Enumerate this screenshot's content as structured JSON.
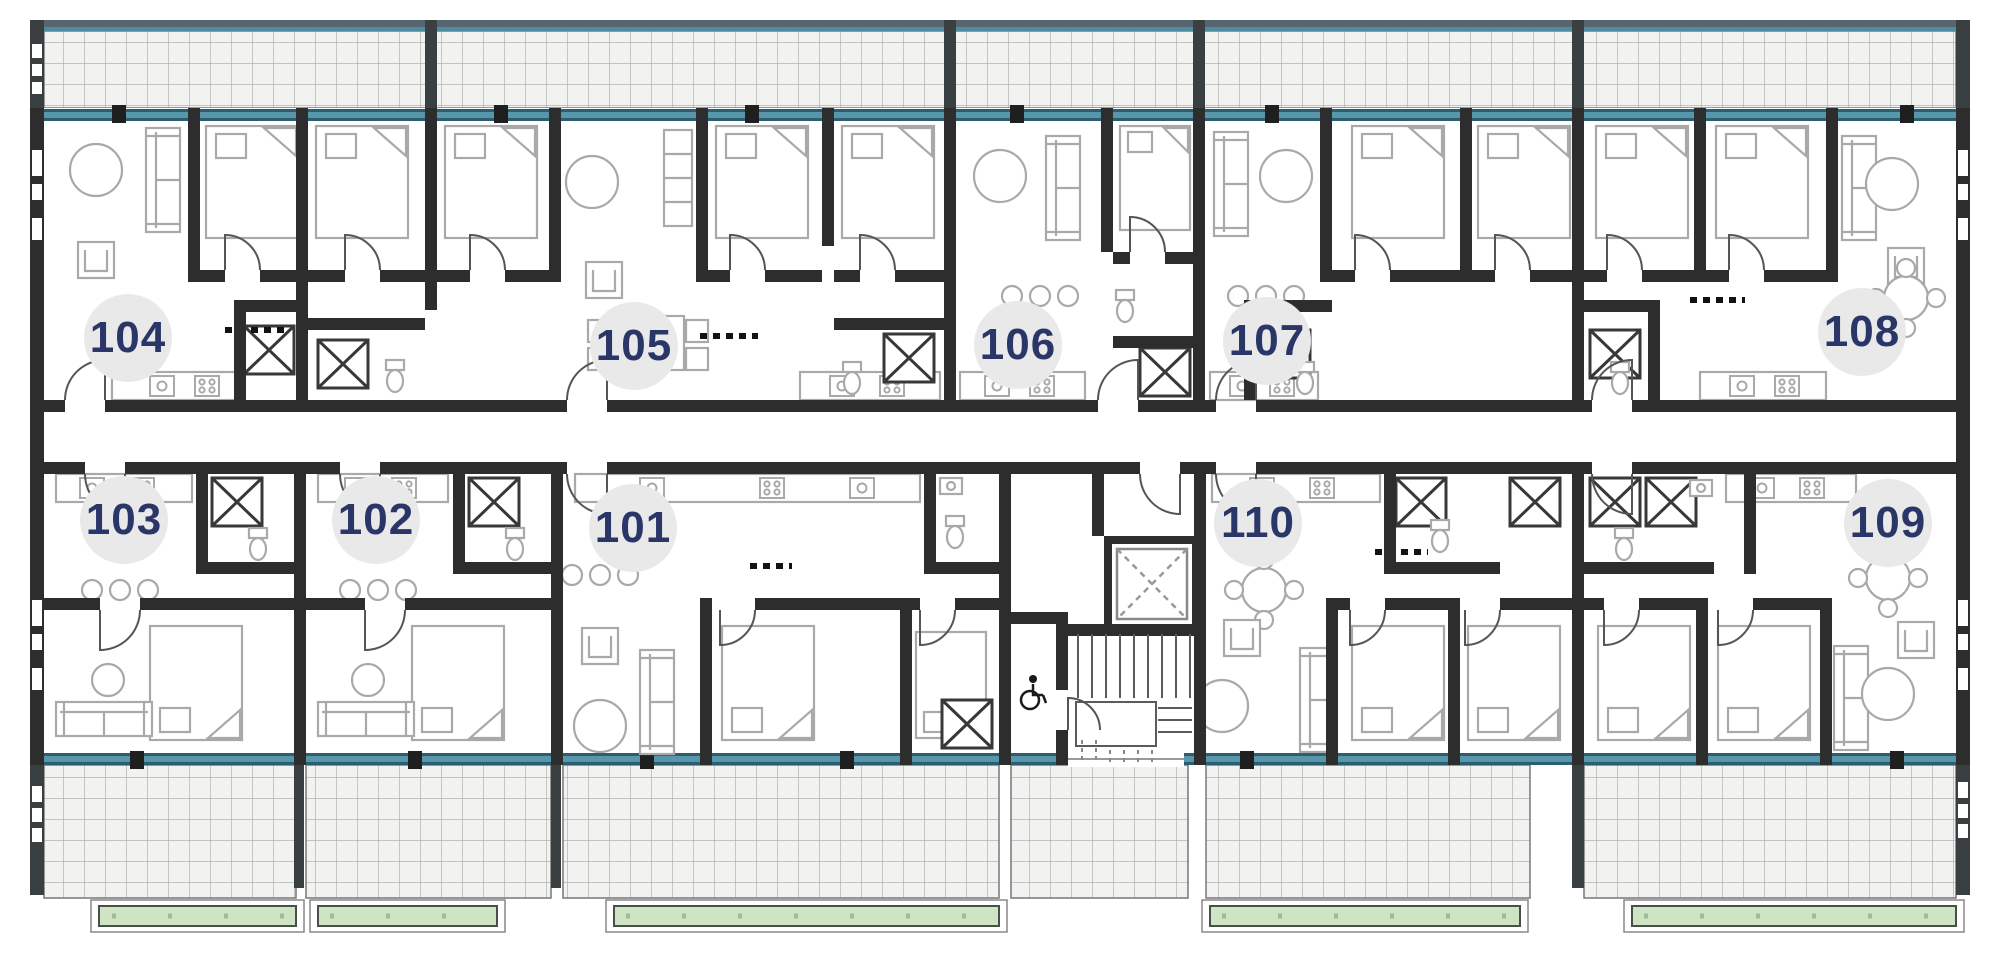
{
  "units": [
    {
      "number": "104",
      "row": "top"
    },
    {
      "number": "105",
      "row": "top"
    },
    {
      "number": "106",
      "row": "top"
    },
    {
      "number": "107",
      "row": "top"
    },
    {
      "number": "108",
      "row": "top"
    },
    {
      "number": "103",
      "row": "bottom"
    },
    {
      "number": "102",
      "row": "bottom"
    },
    {
      "number": "101",
      "row": "bottom"
    },
    {
      "number": "110",
      "row": "bottom"
    },
    {
      "number": "109",
      "row": "bottom"
    }
  ],
  "core": {
    "wheelchair_icon": "wheelchair-accessible-wc",
    "elevator_icon": "elevator-shaft-cross",
    "stairs_icon": "staircase-treads"
  },
  "colors": {
    "wall": "#2d2d2d",
    "terrace_partition": "#3a3f42",
    "window_frame": "#2d5e6f",
    "window_glass": "#5797ab",
    "railing": "#55666e",
    "railing_accent": "#4f8ca3",
    "terrace_fill": "#f2f2f0",
    "terrace_grid_line": "#a4a8a6",
    "green_area": "#cfe4c2",
    "green_border": "#49504a",
    "label_circle": "#e9e9ea",
    "unit_number_text": "#2b3668",
    "furniture_line": "#a9a9a9"
  }
}
